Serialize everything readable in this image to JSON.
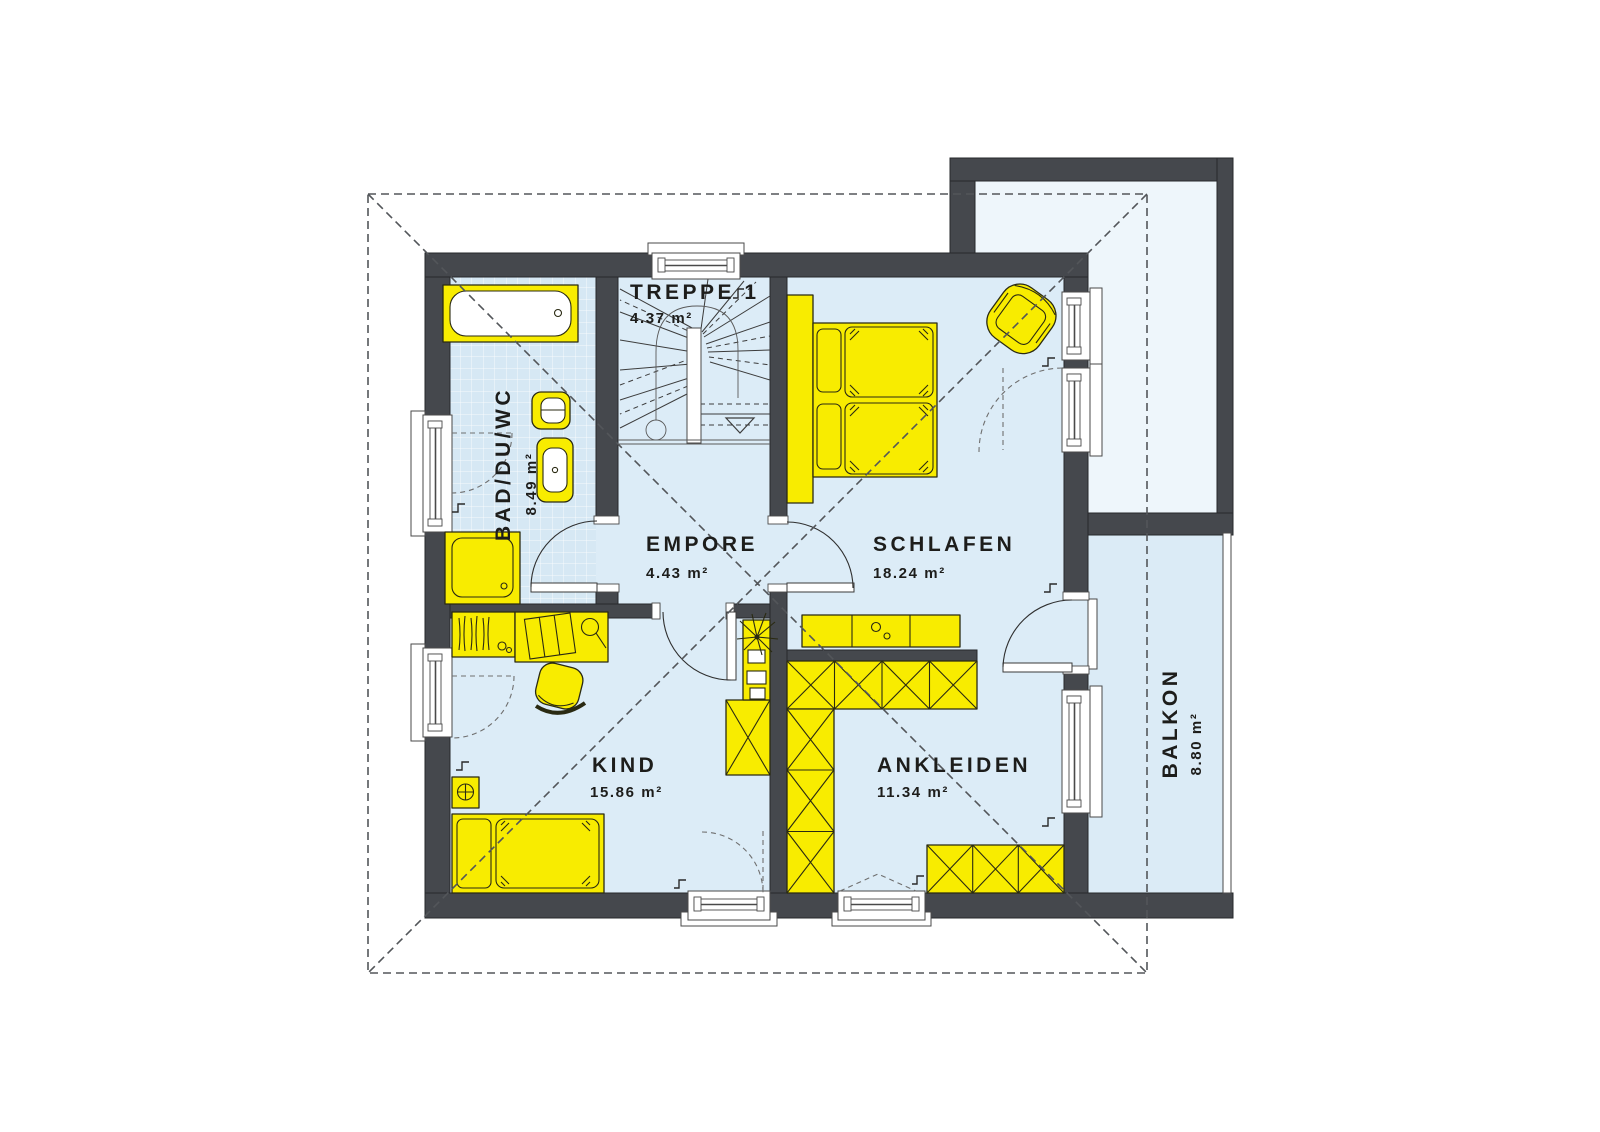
{
  "rooms": {
    "treppe": {
      "name": "TREPPE 1",
      "area": "4.37 m²"
    },
    "bad": {
      "name": "BAD/DU/WC",
      "area": "8.49 m²"
    },
    "empore": {
      "name": "EMPORE",
      "area": "4.43 m²"
    },
    "schlafen": {
      "name": "SCHLAFEN",
      "area": "18.24 m²"
    },
    "kind": {
      "name": "KIND",
      "area": "15.86 m²"
    },
    "ankleiden": {
      "name": "ANKLEIDEN",
      "area": "11.34 m²"
    },
    "balkon": {
      "name": "BALKON",
      "area": "8.80 m²"
    }
  },
  "colors": {
    "wall": "#45484d",
    "floor": "#dcecf7",
    "floor_light": "#eef6fb",
    "balcony": "#dbebf6",
    "tile": "#d6e8f4",
    "yellow": "#f8ec00",
    "ink": "#1d1d1b",
    "dash": "#53565a"
  }
}
